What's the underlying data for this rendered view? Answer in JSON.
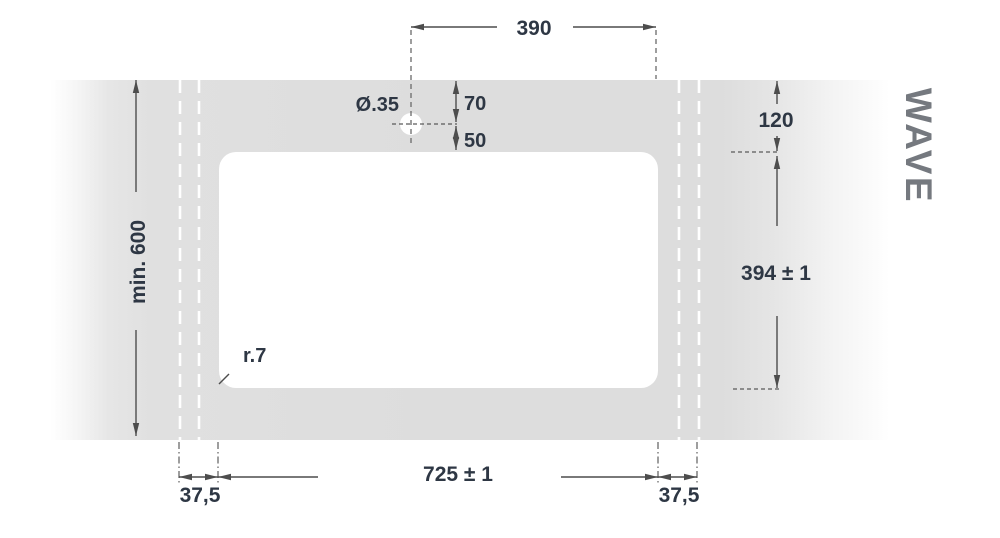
{
  "title": "WAVE",
  "drawing_labels": {
    "hole_offset": "390",
    "hole_diameter": "Ø.35",
    "hole_to_edge": "70",
    "hole_to_cutout": "50",
    "min_depth": "min. 600",
    "edge_to_cutout": "120",
    "cutout_depth": "394 ± 1",
    "corner_radius": "r.7",
    "cutout_width": "725 ± 1",
    "overhang_left": "37,5",
    "overhang_right": "37,5"
  },
  "colors": {
    "worktop_gray": "#dedede",
    "dimension_text": "#2e3744",
    "dimension_line": "#4d4d4d",
    "brand_text": "#75797f"
  }
}
